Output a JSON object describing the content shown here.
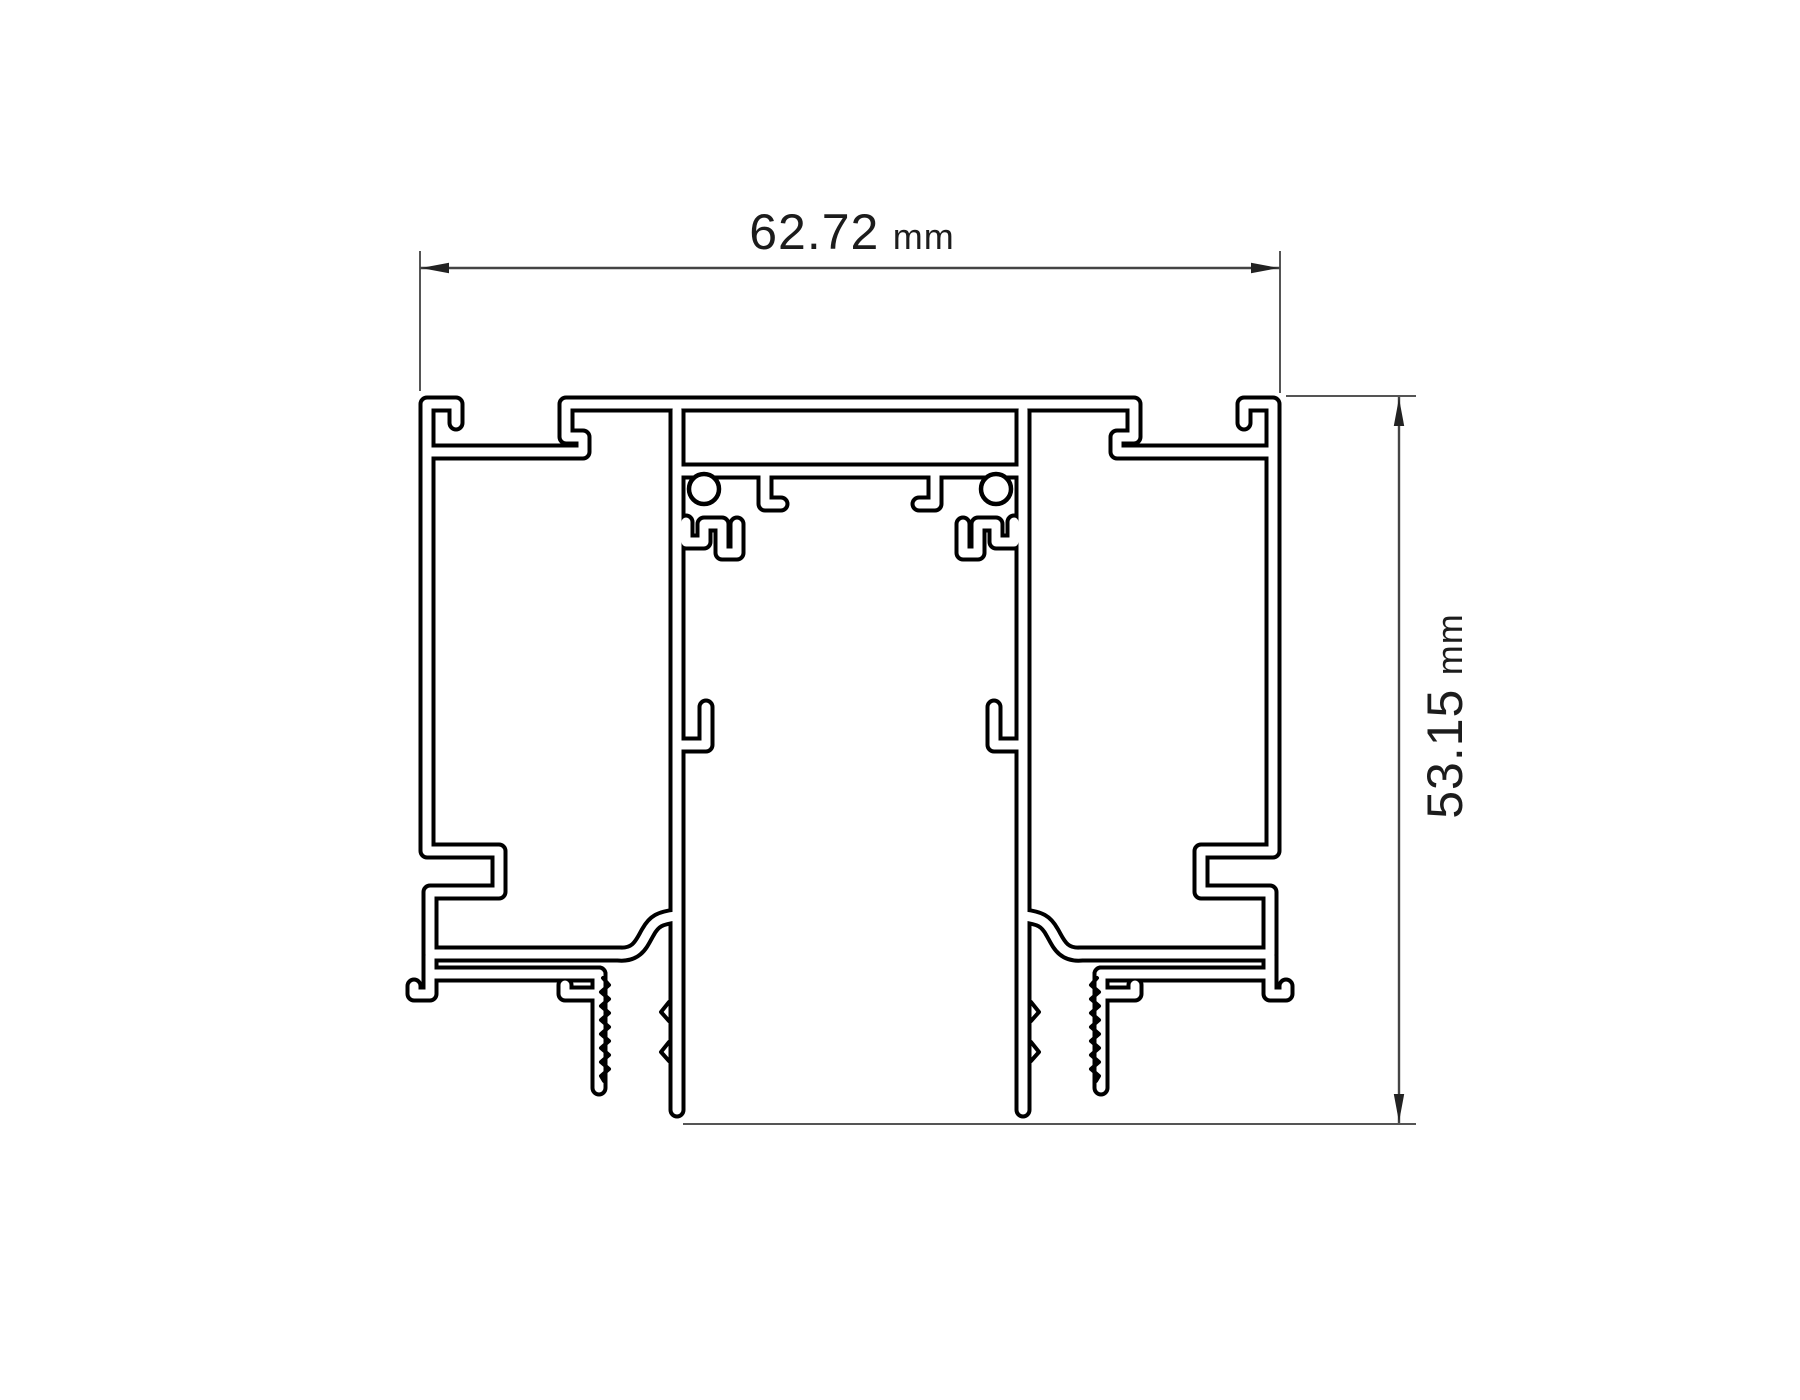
{
  "drawing": {
    "type": "technical-cross-section",
    "subject": "aluminium-extrusion-profile",
    "width_dimension": {
      "value": "62.72",
      "unit": "mm"
    },
    "height_dimension": {
      "value": "53.15",
      "unit": "mm"
    }
  },
  "colors": {
    "background": "#ffffff",
    "profile_line": "#000000",
    "dimension_line": "#444444",
    "dimension_text": "#1c1c1c"
  }
}
